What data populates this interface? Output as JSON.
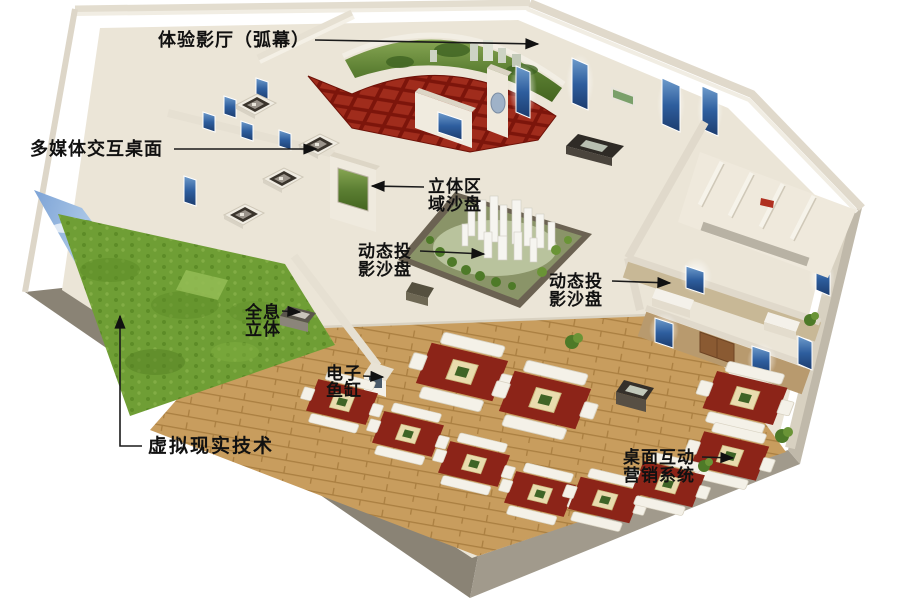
{
  "image_title": "exhibition-hall-3d-floorplan",
  "labels": {
    "theater": {
      "text": "体验影厅（弧幕）"
    },
    "multimedia": {
      "text": "多媒体交互桌面"
    },
    "stereo_zone": {
      "line1": "立体区",
      "line2": "域沙盘"
    },
    "dynamic_center": {
      "line1": "动态投",
      "line2": "影沙盘"
    },
    "dynamic_right": {
      "line1": "动态投",
      "line2": "影沙盘"
    },
    "hologram": {
      "line1": "全息",
      "line2": "立体"
    },
    "fishtank": {
      "line1": "电子",
      "line2": "鱼缸"
    },
    "vr": {
      "text": "虚拟现实技术"
    },
    "marketing": {
      "line1": "桌面互动",
      "line2": "营销系统"
    }
  },
  "colors": {
    "background": "#ffffff",
    "wall_top": "#e6e0d2",
    "wall_face": "#f2eee5",
    "wall_exterior_dark": "#8a8375",
    "wall_exterior_light": "#a19a8c",
    "floor_main": "#ebe5d7",
    "floor_wood": "#c89d5e",
    "theater_carpet": "#8c1d10",
    "theater_seat": "#a02c1c",
    "grass": "#6f9e35",
    "sky_mural": "#9cc0e8",
    "screen_panel_blue": "#2e5e9e",
    "sand_platform": "#6b6252",
    "building_white": "#f6f5f0",
    "wing_wall_tan": "#b89a6e",
    "sofa_carpet_red": "#8c2418",
    "door_brown": "#8a5a32",
    "sign_red": "#b03020",
    "label_text": "#111111"
  }
}
